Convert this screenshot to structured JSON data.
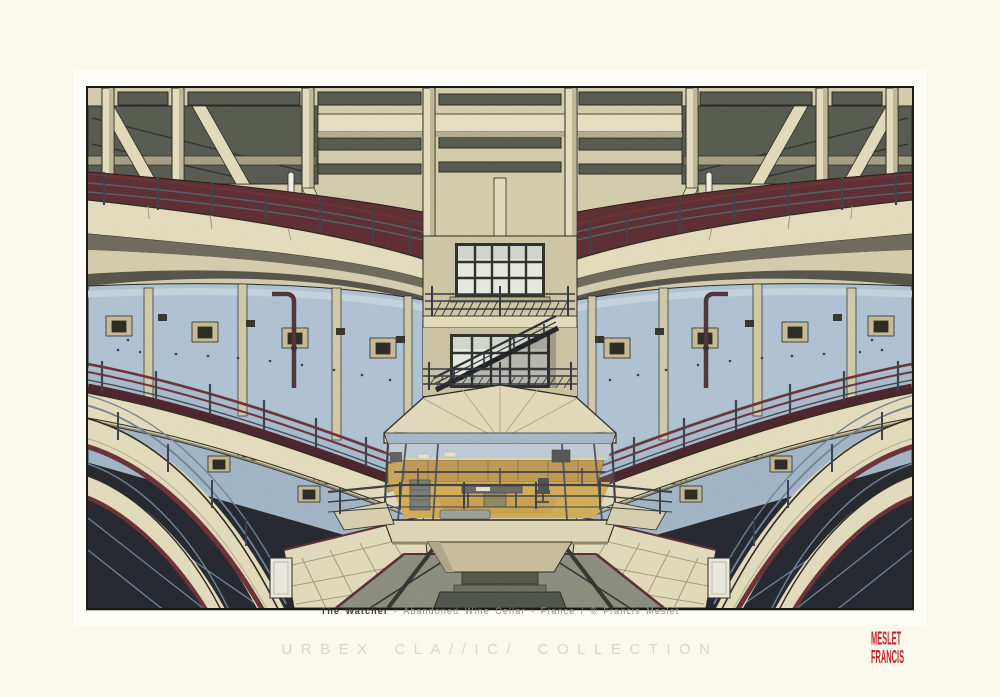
{
  "poster": {
    "caption": {
      "title": "The Watcher",
      "rest": "- Abandoned Wine Cellar - France / © Francis Meslet"
    },
    "collection": {
      "display": "URBEX CLA//IC/ COLLECTION",
      "text": "URBEX CLASSICS COLLECTION"
    },
    "seal": {
      "line1": "MESLET",
      "line2": "FRANCIS",
      "color": "#c0272d"
    },
    "artwork": {
      "title": "The Watcher",
      "subject": "Wide-angle illustration of a multi-storey atrium in an abandoned wine cellar with a central octagonal glass watch office lit in amber",
      "palette": {
        "page_cream": "#fbf9eb",
        "mat_white": "#fffef9",
        "concrete_beige": "#d8d2b1",
        "beam_cream": "#eae2c2",
        "ceiling_coffer": "#565a4f",
        "wall_maroon": "#5d2a31",
        "tank_blue": "#b3c7da",
        "tank_blue_low": "#a4b9cd",
        "shadow_navy": "#21242c",
        "office_amber": "#d9a83f",
        "cabinet_mustard": "#c3913b",
        "floor_gray": "#8d8f80",
        "railing_steel": "#3a4049",
        "railing_maroon": "#6b2f35",
        "outline_ink": "#26261f"
      }
    }
  }
}
